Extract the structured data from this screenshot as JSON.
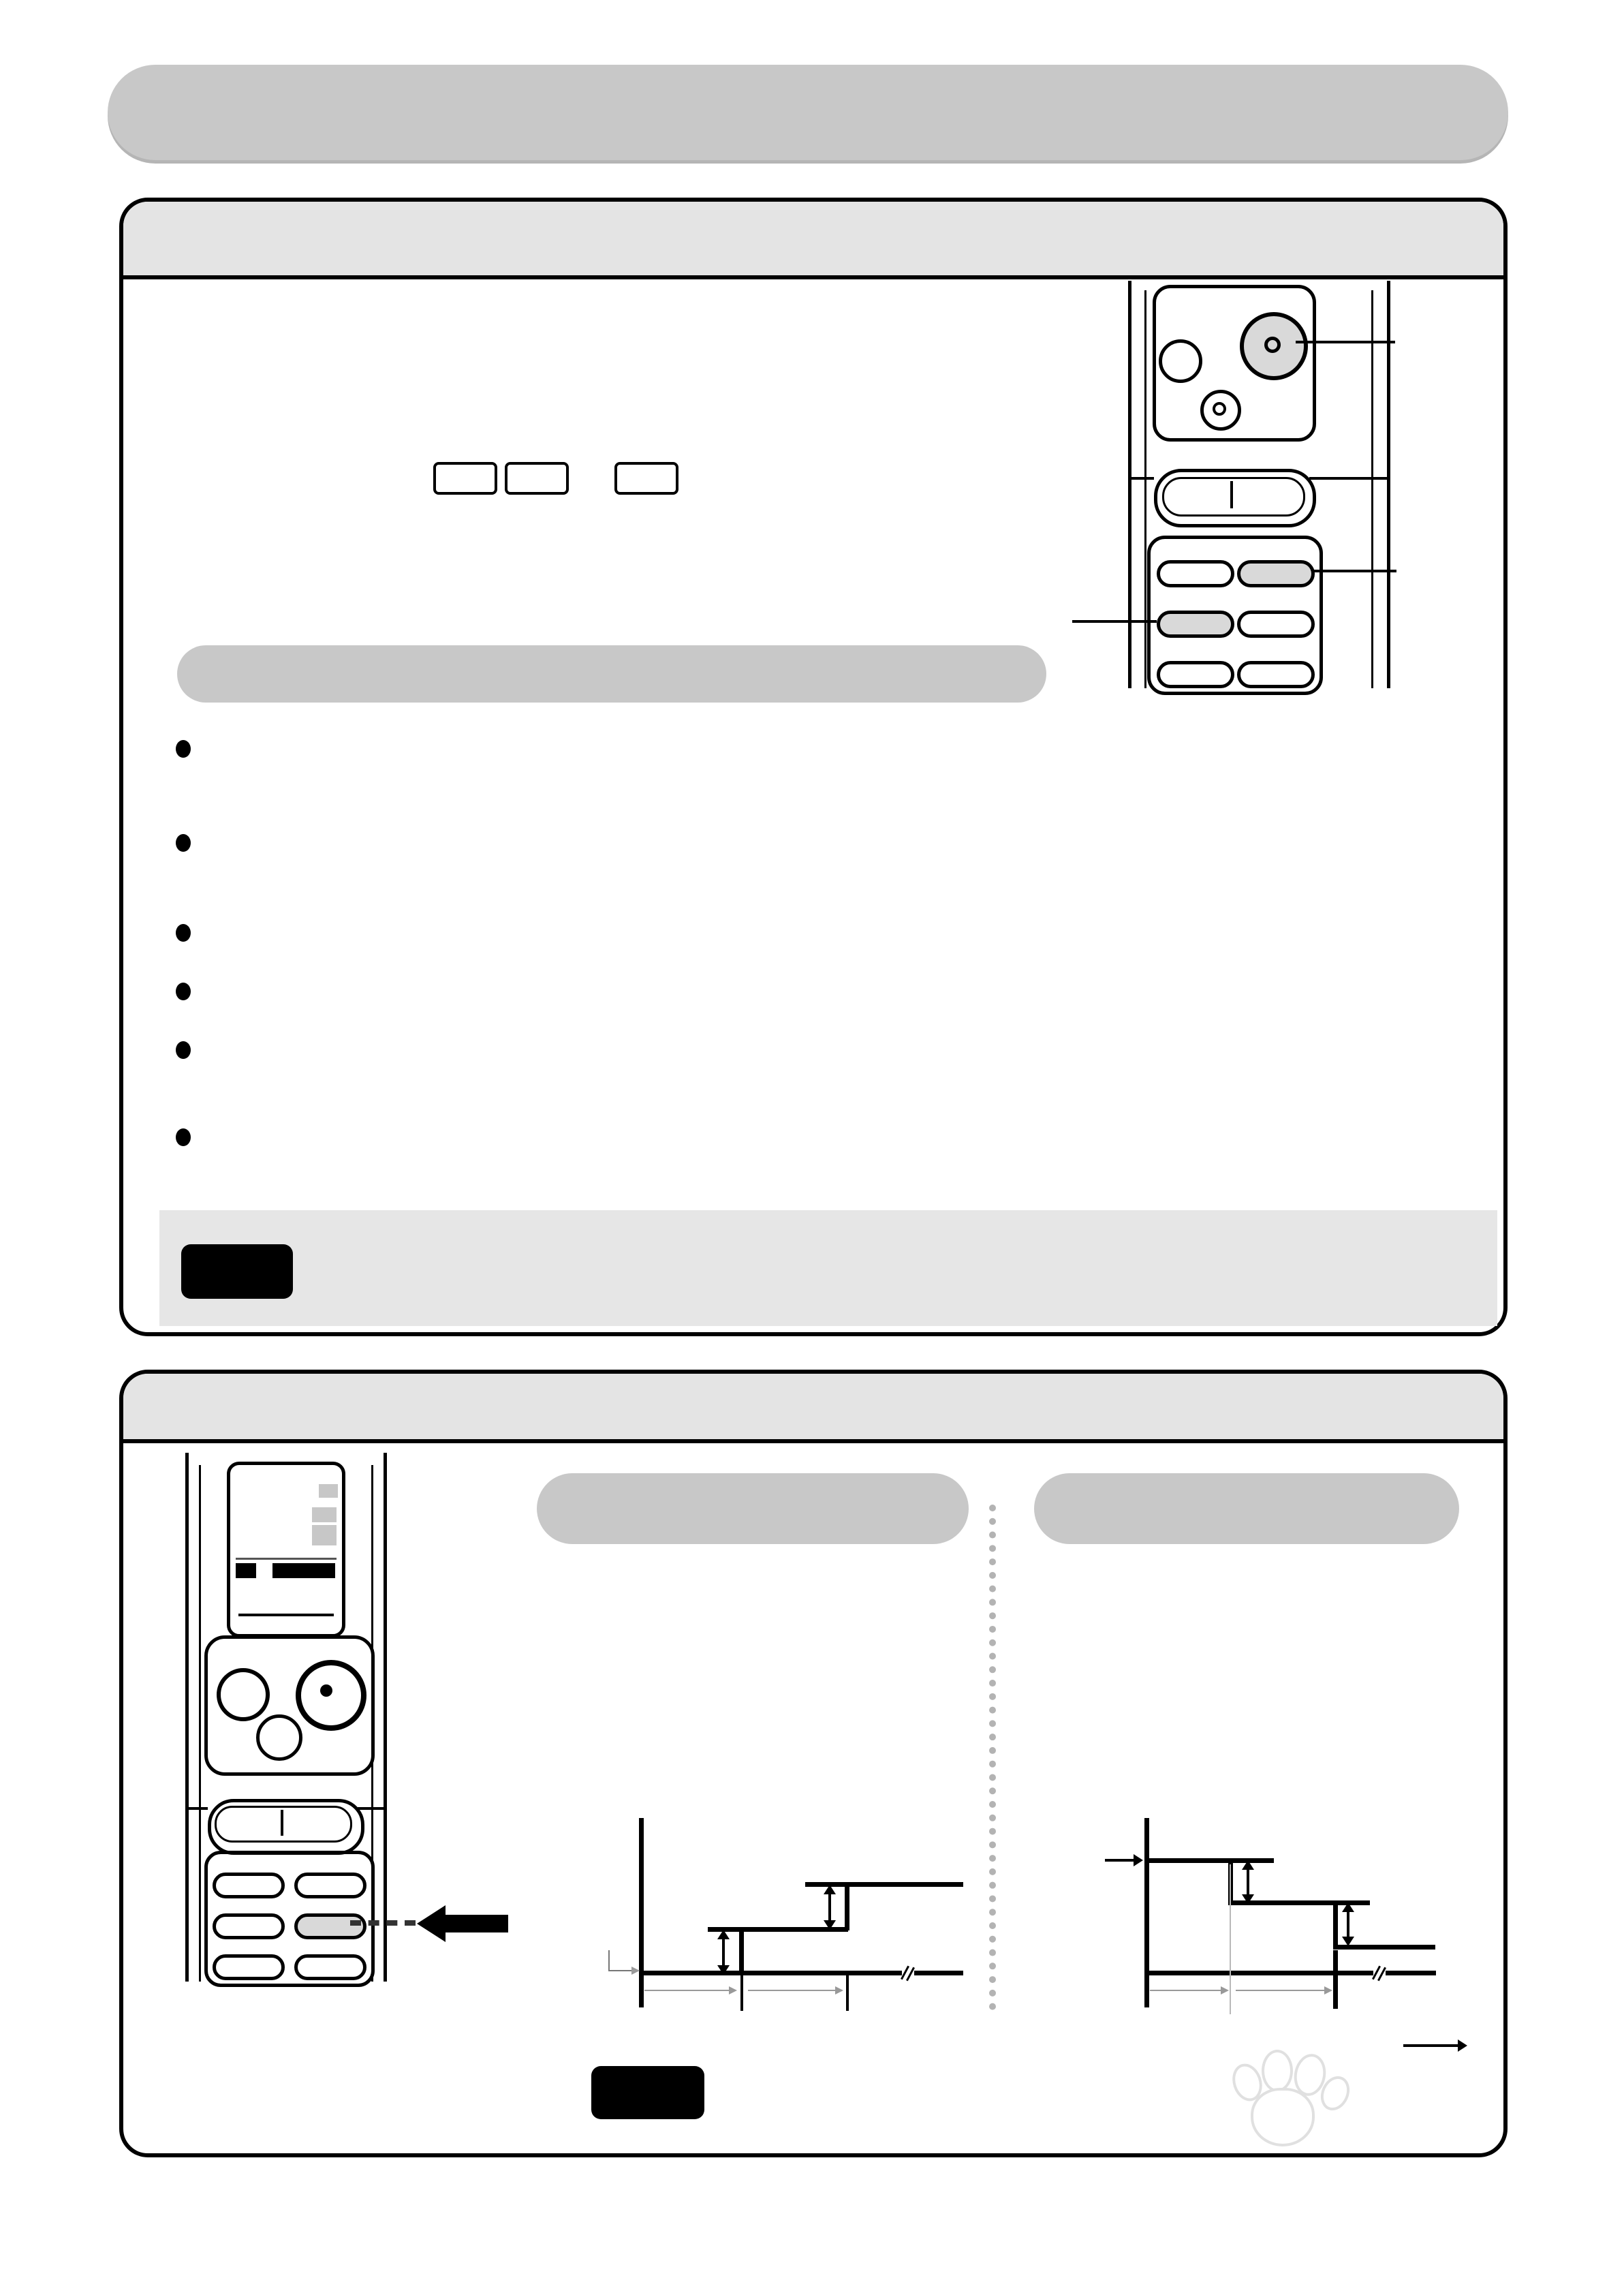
{
  "title": {
    "text": "遥　控　器　使　用　方　法"
  },
  "page_number": "11",
  "watermark": {
    "brand_bai": "Bai",
    "du": "du",
    "brand_suffix": "经验",
    "url": "jingyan.baidu.com"
  },
  "section4": {
    "number": "4",
    "or_label": "or",
    "fan_icons": {
      "high": "✣))",
      "medium": "✣)",
      "low": "✣"
    },
    "callouts": {
      "step2": "²Ä¤G¨B",
      "step1": "²Ä¤@¨B",
      "step3": "²Ä¤T¨B"
    },
    "notice_label": "注意",
    "remote": {
      "vitality": "活氣",
      "power": "運轉/停止",
      "hour_off_line1": "1小時後",
      "hour_off_line2": "關閉",
      "temp_set": "溫度設定",
      "rocker_down": "▽",
      "rocker_up": "△",
      "buttons": {
        "uv": "UV除菌",
        "function": "功能",
        "fan_speed": "風量",
        "timer": "定時",
        "fan_dir": "風向",
        "powerful": "強力運轉"
      }
    }
  },
  "section5": {
    "number": "5",
    "panel_a": "A",
    "panel_b": "B",
    "notice_label": "注意",
    "notes": [
      "¦b§N·x©Î°£Àã¥\\¯à¤U«ö¤U",
      "¦w¯v,ªÅ½Õ¾÷§Y¶i¦æ¦w¯v",
      "¥\\¯à,¦A«ö¤@¦¸,§Y¤©¸Ñ°£¡C"
    ],
    "remote": {
      "vitality": "活氣",
      "power": "運轉/停止",
      "hour_off_line1": "1小時後",
      "hour_off_line2": "關閉",
      "c_button": "C",
      "temp_set": "溫度設定",
      "rocker_down": "▽",
      "rocker_up": "△",
      "buttons": {
        "uv": "UV除菌",
        "function": "功能",
        "fan_speed": "風量",
        "timer": "定時",
        "fan_dir": "風向",
        "powerful": "強力運轉"
      },
      "lcd": {
        "ghost1": "自動風向除溫冷房",
        "ghost2": "送風(○9○)",
        "uv_tag": "UV",
        "side_tag1": "快速",
        "side_tag2": "ハイパ",
        "left_tag1": "定",
        "left_tag2": "溫",
        "temp": "27",
        "temp_unit": "℃",
        "mode_tag1": "⊙",
        "mode_tag2": "入切勻",
        "time": "10:20",
        "fs_tag": "風量",
        "fs_auto": "自動",
        "fd_tag": "風向",
        "fd_auto": "自動",
        "fan_glyph": "✣"
      }
    }
  },
  "chart_data": [
    {
      "panel": "A",
      "type": "line",
      "subtype": "step_up",
      "set_point_label": "³]©w·Å«×",
      "x_intervals_min": [
        30,
        30
      ],
      "x_interval_labels": [
        "30 min.",
        "30 min."
      ],
      "x_axis_label": "®É",
      "step_delta_labels": [
        "1¢J",
        "1¢J"
      ],
      "step_deltas_c": [
        1,
        1
      ],
      "temp_offsets_c": [
        0,
        1,
        2
      ],
      "grid": false,
      "legend": "none"
    },
    {
      "panel": "B",
      "type": "line",
      "subtype": "step_down",
      "set_point_label": "³]©w·Å«×",
      "x_intervals_min": [
        30,
        30
      ],
      "x_interval_labels": [
        "30 min.",
        "30 min."
      ],
      "x_axis_label": "®É",
      "step_delta_labels": [
        "2¢J",
        "2¢J"
      ],
      "step_deltas_c": [
        -2,
        -2
      ],
      "temp_offsets_c": [
        0,
        -2,
        -4
      ],
      "grid": false,
      "legend": "none"
    }
  ]
}
